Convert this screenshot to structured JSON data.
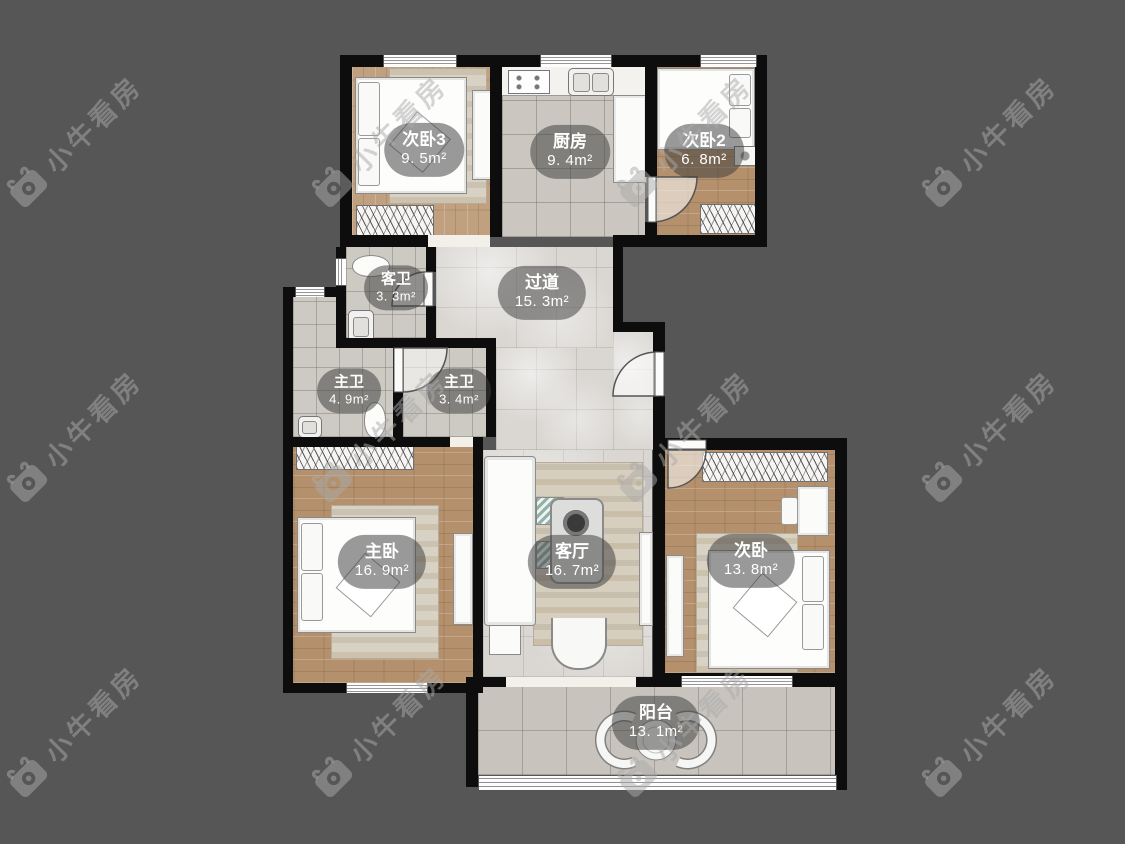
{
  "watermark": {
    "text": "小牛看房",
    "logo_icon": "bull-camera-logo"
  },
  "rooms": {
    "bedroom3": {
      "name": "次卧3",
      "area": "9. 5m²"
    },
    "kitchen": {
      "name": "厨房",
      "area": "9. 4m²"
    },
    "bedroom2": {
      "name": "次卧2",
      "area": "6. 8m²"
    },
    "guest_bathroom": {
      "name": "客卫",
      "area": "3. 3m²"
    },
    "hallway": {
      "name": "过道",
      "area": "15. 3m²"
    },
    "master_bathroom_1": {
      "name": "主卫",
      "area": "4. 9m²"
    },
    "master_bathroom_2": {
      "name": "主卫",
      "area": "3. 4m²"
    },
    "master_bedroom": {
      "name": "主卧",
      "area": "16. 9m²"
    },
    "living_room": {
      "name": "客厅",
      "area": "16. 7m²"
    },
    "bedroom": {
      "name": "次卧",
      "area": "13. 8m²"
    },
    "balcony": {
      "name": "阳台",
      "area": "13. 1m²"
    }
  },
  "colors": {
    "background": "#565656",
    "wall": "#0d0d0d",
    "watermark": "#7d7d7d",
    "label_pill": "rgba(62,62,62,0.52)",
    "label_text": "#ffffff",
    "wood_floor": "#b8946f",
    "tile_floor": "#cdc9c3"
  }
}
